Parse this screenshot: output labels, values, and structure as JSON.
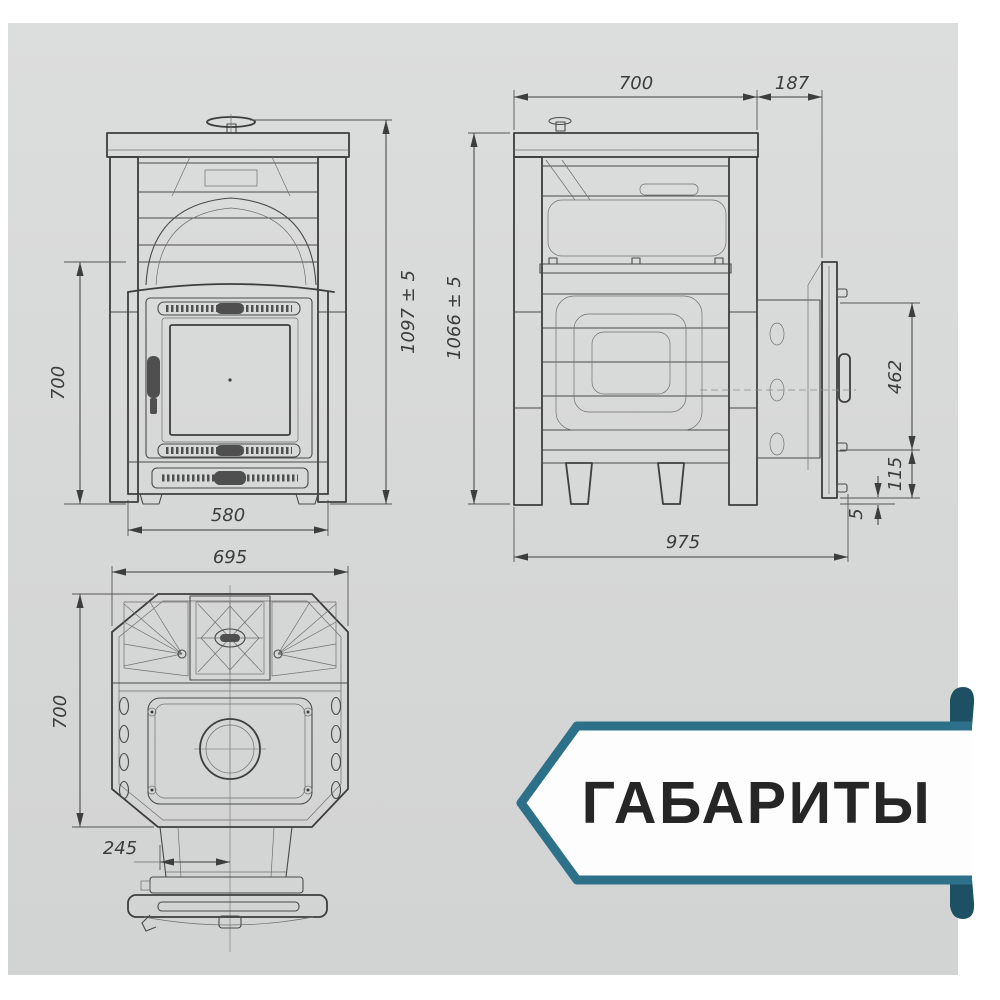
{
  "banner": {
    "label": "ГАБАРИТЫ",
    "accent_color": "#2d7089",
    "accent_dark_color": "#1d5063",
    "bg_color": "#fdfdfe",
    "text_color": "#262626"
  },
  "card": {
    "bg_color": "#d7d8d8"
  },
  "drawing": {
    "front_view": {
      "dims": {
        "overall_height": "1097 ± 5",
        "body_height": "700",
        "body_width": "580"
      }
    },
    "side_view": {
      "dims": {
        "body_depth": "700",
        "door_offset": "187",
        "overall_height": "1066 ± 5",
        "door_height": "462",
        "door_bottom_offset": "115",
        "floor_gap": "5",
        "overall_depth": "975"
      }
    },
    "top_view": {
      "dims": {
        "overall_width": "695",
        "overall_depth": "700",
        "tunnel_offset": "245"
      }
    }
  }
}
